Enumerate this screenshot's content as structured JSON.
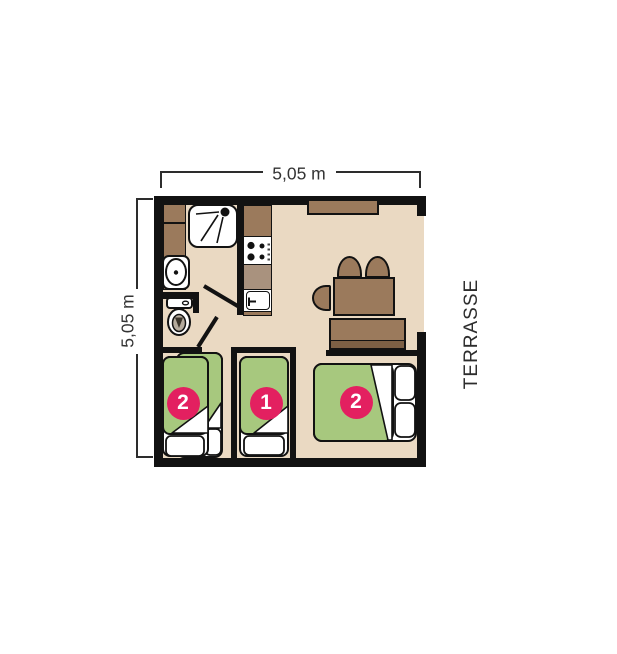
{
  "plan": {
    "dimension_top": {
      "label": "5,05 m"
    },
    "dimension_left": {
      "label": "5,05 m"
    },
    "terrace_label": "TERRASSE",
    "bedrooms": [
      {
        "name": "bedroom-left",
        "bed_count_badge": "2"
      },
      {
        "name": "bedroom-middle",
        "bed_count_badge": "1"
      },
      {
        "name": "bedroom-right",
        "bed_count_badge": "2"
      }
    ],
    "fixtures": [
      "shower",
      "washbasin",
      "toilet",
      "wardrobe",
      "kitchen-cabinet",
      "stove",
      "kitchen-sink",
      "window",
      "dining-table",
      "chair",
      "sofa",
      "single-bed",
      "double-bed",
      "pillow",
      "terrace-opening",
      "door-leaf"
    ]
  },
  "colors": {
    "wall": "#121212",
    "floor": "#ead9c2",
    "wood": "#9b7a5c",
    "wood-dark": "#7d6045",
    "counter": "#a9927e",
    "bed-green": "#a7c87e",
    "badge-pink": "#e32060",
    "dim-line": "#2d2d2d",
    "label-text": "#333333",
    "toilet-seat": "#b5ab9d"
  }
}
